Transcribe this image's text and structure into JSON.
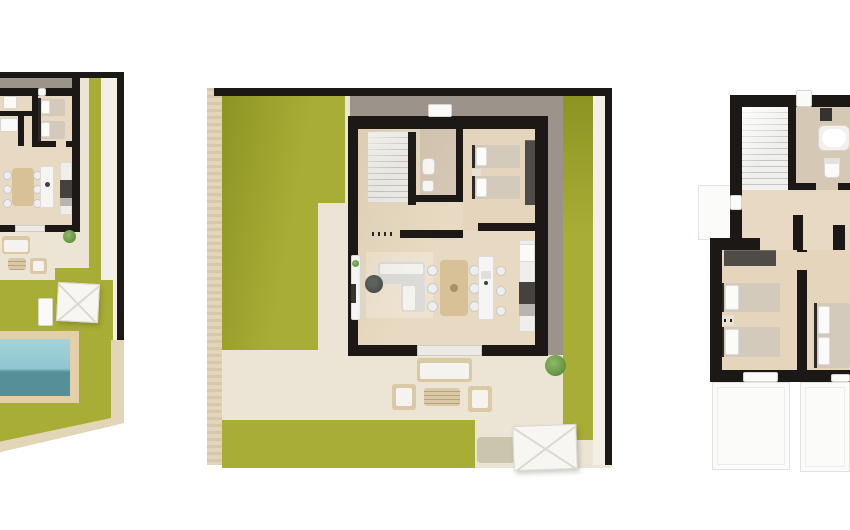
{
  "meta": {
    "title": "Villa floor plans — three top-view 3D renders",
    "figure_type": "architectural-floor-plans",
    "background": "#ffffff"
  },
  "colors": {
    "wall": "#1b1815",
    "ground": "#ece4d4",
    "ground_light": "#f3efe7",
    "lawn": "#a8ad35",
    "lawn_shadow": "#8c9422",
    "pool_light": "#a6d3da",
    "pool_deep": "#568f97",
    "deck": "#e4d0a8",
    "border_beige": "#e3d5b8",
    "gray_path": "#9c948a",
    "wood": "#e8dac2",
    "wood_bed": "#e5d5bd",
    "tile": "#d5c8b4",
    "stairs": "#efefed",
    "stair_line": "#c6c5c2",
    "white_fixture": "#fafaf8",
    "sofa": "#dbdbd7",
    "table_wood": "#d8c196",
    "chair": "#edefee",
    "island": "#f5f5f3",
    "counter_dark": "#45423d",
    "wardrobe": "#4f4c47",
    "bed_blanket": "#d3cabb",
    "bed_white": "#fbfbfa",
    "headboard": "#2d2a26",
    "rattan": "#d9c9a4",
    "cushion": "#f4f3f0",
    "plant": "#6d9c49",
    "tv_dark": "#35332f",
    "parasol": "#f7f6f2",
    "terrace_line": "#e2e2de"
  },
  "plans": [
    {
      "id": "plan-left",
      "semantic": "ground-floor-site-plan-with-pool-cropped-at-left-edge",
      "elements": [
        "boundary-wall",
        "lawn",
        "bedroom-two-single-beds",
        "bathroom-fixtures",
        "dining-table-with-chairs",
        "kitchen-island",
        "kitchen-counter",
        "outdoor-lounge-set",
        "sun-lounger",
        "parasol",
        "swimming-pool",
        "pool-deck",
        "plant",
        "diagonal-plot-edge"
      ]
    },
    {
      "id": "plan-center",
      "semantic": "ground-floor-plan-with-garden",
      "elements": [
        "boundary-wall",
        "garden-lawn",
        "gravel-path",
        "staircase",
        "bathroom-toilet-sink",
        "bedroom-two-single-beds",
        "wardrobe",
        "l-shaped-sofa",
        "round-coffee-table",
        "tv-sideboard",
        "dining-table-six-chairs",
        "kitchen-island-three-stools",
        "kitchen-counter-oven",
        "sliding-door",
        "outdoor-lounge-set",
        "parasol",
        "plants"
      ]
    },
    {
      "id": "plan-right",
      "semantic": "upper-floor-plan-cropped-at-right-edge",
      "elements": [
        "staircase",
        "bathroom-bathtub-toilet",
        "landing",
        "wardrobe",
        "bedroom-two-single-beds",
        "nightstand",
        "bedroom-double-bed",
        "terrace-outlines"
      ]
    }
  ]
}
